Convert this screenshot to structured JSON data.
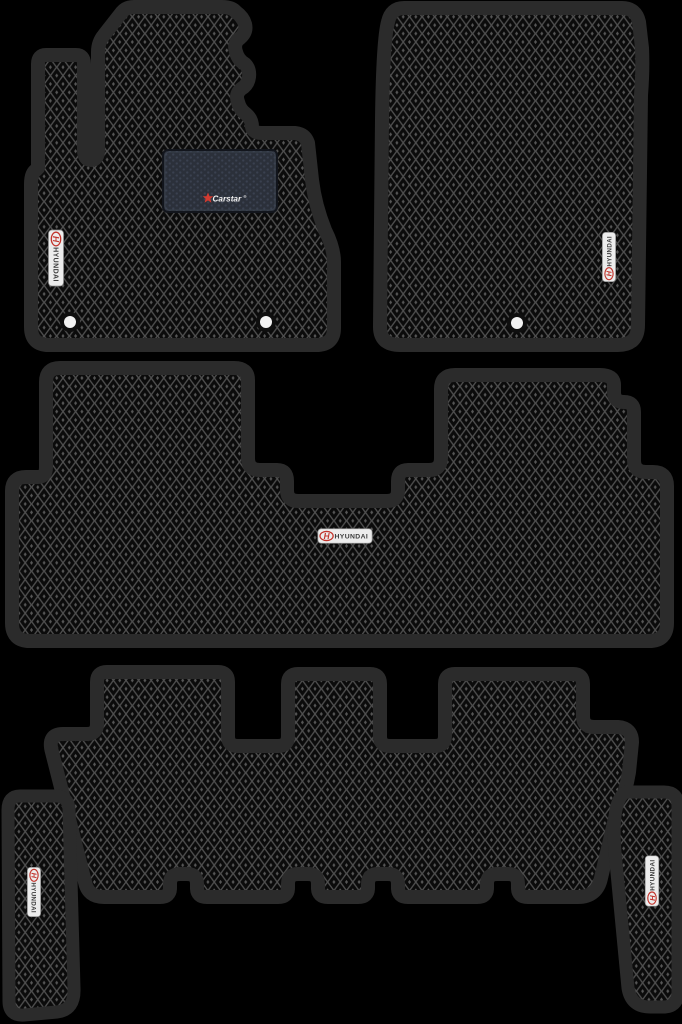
{
  "scene": {
    "subject": "Set of six black EVA car floor mats with diamond rhombus texture",
    "background_color": "#000000"
  },
  "brand_badge": {
    "logo_letter": "H",
    "brand_text": "HYUNDAI",
    "badge_bg": "#ececec",
    "badge_border": "#8f8f8f",
    "accent_red": "#c2342c",
    "text_color": "#3a3a3a"
  },
  "heel_pad": {
    "logo_text": "Carstar",
    "registered_mark": "®",
    "star_icon": "★",
    "pad_bg": "#2b303a",
    "dot_color": "#3a4150",
    "logo_red": "#d23b31",
    "logo_text_color": "#f4f4f4"
  },
  "mat_surface": {
    "edge_color": "#2b2b2b",
    "lattice_color": "#4f4f4f",
    "cell_color": "#0b0b0b",
    "center_dot_color": "#565656"
  },
  "fastener_hole": {
    "ring_color": "#0f0f0f",
    "fill_color": "#f2f2f2"
  },
  "mats": [
    {
      "name": "front-driver-mat",
      "badge": "HYUNDAI",
      "heel_pad": "Carstar®",
      "holes": 2
    },
    {
      "name": "front-passenger-mat",
      "badge": "HYUNDAI",
      "holes": 1
    },
    {
      "name": "second-row-mat",
      "badge": "HYUNDAI",
      "holes": 0
    },
    {
      "name": "third-row-mat",
      "badge": null,
      "holes": 0
    },
    {
      "name": "left-rear-side-mat",
      "badge": "HYUNDAI",
      "holes": 0
    },
    {
      "name": "right-rear-side-mat",
      "badge": "HYUNDAI",
      "holes": 0
    }
  ]
}
